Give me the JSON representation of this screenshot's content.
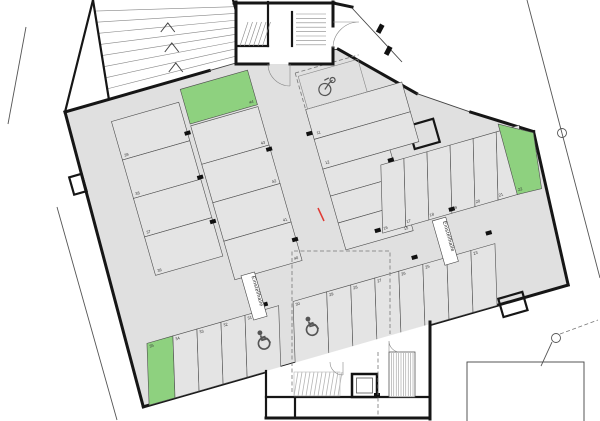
{
  "hall": {
    "label": "Einstellhalle",
    "colors": {
      "floor": "#e0e0e0",
      "highlight": "#8ed17f",
      "wall": "#161616",
      "marker_red": "#e03a34"
    },
    "rows": {
      "left_col_1": [
        39,
        38,
        37,
        36
      ],
      "left_col_2": [
        44,
        43,
        42,
        41,
        40
      ],
      "wide_spaces": [
        11,
        12
      ],
      "middle_col": [
        13,
        14,
        15
      ],
      "top_right_row": [
        16,
        17,
        18,
        19,
        20,
        21,
        22
      ],
      "bottom_right_row": [
        30,
        29,
        28,
        27,
        26,
        25,
        24,
        23
      ],
      "bottom_left_row": [
        35,
        34,
        33,
        32,
        31
      ]
    },
    "highlighted_spaces": [
      44,
      22,
      35
    ],
    "accessible_spaces": [
      30,
      31
    ],
    "icons": [
      "bicycle-icon",
      "wheelchair-icon",
      "wheelchair-icon",
      "ramp-direction-arrows",
      "grid-bubble-marker"
    ]
  }
}
